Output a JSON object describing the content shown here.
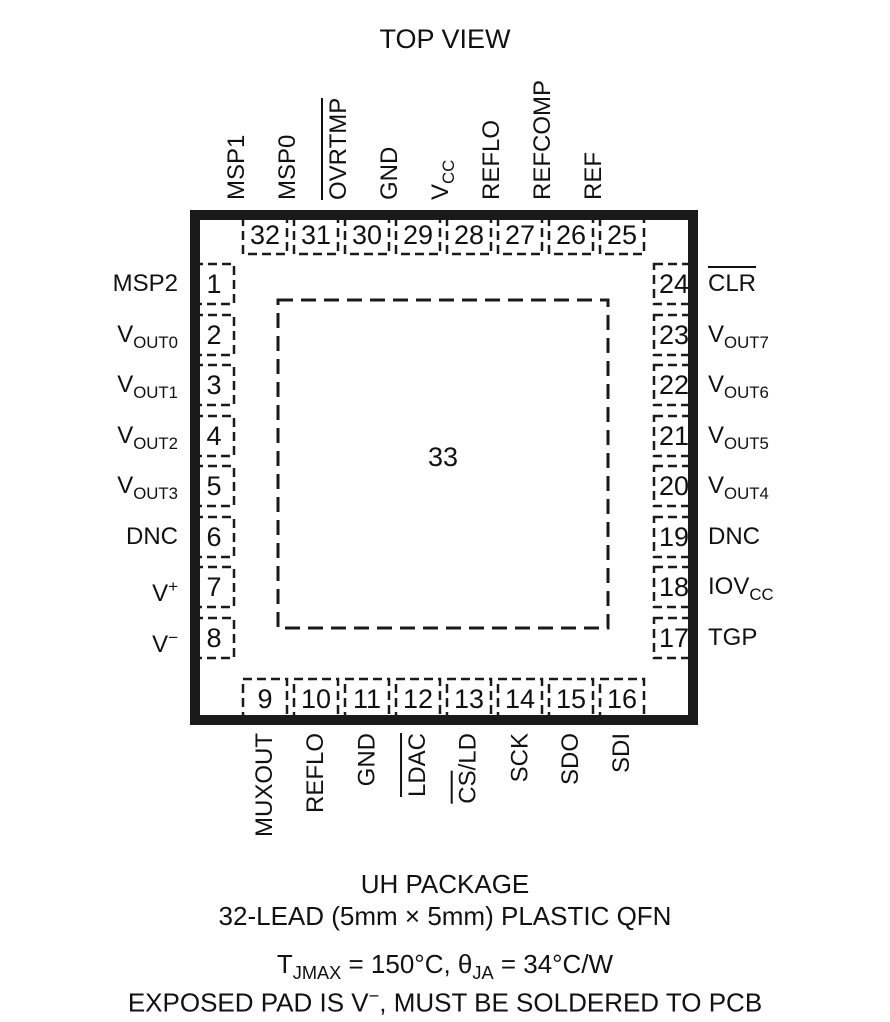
{
  "title": "TOP VIEW",
  "exposed_pad": {
    "number": "33"
  },
  "pins": {
    "top": [
      {
        "num": "32",
        "label": {
          "base": "MSP1"
        }
      },
      {
        "num": "31",
        "label": {
          "base": "MSP0"
        }
      },
      {
        "num": "30",
        "label": {
          "ov": "OVRTMP"
        }
      },
      {
        "num": "29",
        "label": {
          "base": "GND"
        }
      },
      {
        "num": "28",
        "label": {
          "base": "V",
          "sub": "CC"
        }
      },
      {
        "num": "27",
        "label": {
          "base": "REFLO"
        }
      },
      {
        "num": "26",
        "label": {
          "base": "REFCOMP"
        }
      },
      {
        "num": "25",
        "label": {
          "base": "REF"
        }
      }
    ],
    "left": [
      {
        "num": "1",
        "label": {
          "base": "MSP2"
        }
      },
      {
        "num": "2",
        "label": {
          "base": "V",
          "sub": "OUT0"
        }
      },
      {
        "num": "3",
        "label": {
          "base": "V",
          "sub": "OUT1"
        }
      },
      {
        "num": "4",
        "label": {
          "base": "V",
          "sub": "OUT2"
        }
      },
      {
        "num": "5",
        "label": {
          "base": "V",
          "sub": "OUT3"
        }
      },
      {
        "num": "6",
        "label": {
          "base": "DNC"
        }
      },
      {
        "num": "7",
        "label": {
          "base": "V",
          "sup": "+"
        }
      },
      {
        "num": "8",
        "label": {
          "base": "V",
          "sup": "−"
        }
      }
    ],
    "right": [
      {
        "num": "24",
        "label": {
          "ov": "CLR"
        }
      },
      {
        "num": "23",
        "label": {
          "base": "V",
          "sub": "OUT7"
        }
      },
      {
        "num": "22",
        "label": {
          "base": "V",
          "sub": "OUT6"
        }
      },
      {
        "num": "21",
        "label": {
          "base": "V",
          "sub": "OUT5"
        }
      },
      {
        "num": "20",
        "label": {
          "base": "V",
          "sub": "OUT4"
        }
      },
      {
        "num": "19",
        "label": {
          "base": "DNC"
        }
      },
      {
        "num": "18",
        "label": {
          "base": "IOV",
          "sub": "CC"
        }
      },
      {
        "num": "17",
        "label": {
          "base": "TGP"
        }
      }
    ],
    "bottom": [
      {
        "num": "9",
        "label": {
          "base": "MUXOUT"
        }
      },
      {
        "num": "10",
        "label": {
          "base": "REFLO"
        }
      },
      {
        "num": "11",
        "label": {
          "base": "GND"
        }
      },
      {
        "num": "12",
        "label": {
          "ov": "LDAC"
        }
      },
      {
        "num": "13",
        "label": {
          "ov": "CS",
          "rest": "/LD"
        }
      },
      {
        "num": "14",
        "label": {
          "base": "SCK"
        }
      },
      {
        "num": "15",
        "label": {
          "base": "SDO"
        }
      },
      {
        "num": "16",
        "label": {
          "base": "SDI"
        }
      }
    ]
  },
  "caption": {
    "package_name": "UH PACKAGE",
    "package_desc": "32-LEAD (5mm × 5mm) PLASTIC QFN",
    "thermal": {
      "t": "T",
      "t_sub": "JMAX",
      "mid": " = 150°C, θ",
      "theta_sub": "JA",
      "tail": " = 34°C/W"
    },
    "exposed": {
      "pre": "EXPOSED PAD IS V",
      "sup": "−",
      "post": ", MUST BE SOLDERED TO PCB"
    }
  }
}
